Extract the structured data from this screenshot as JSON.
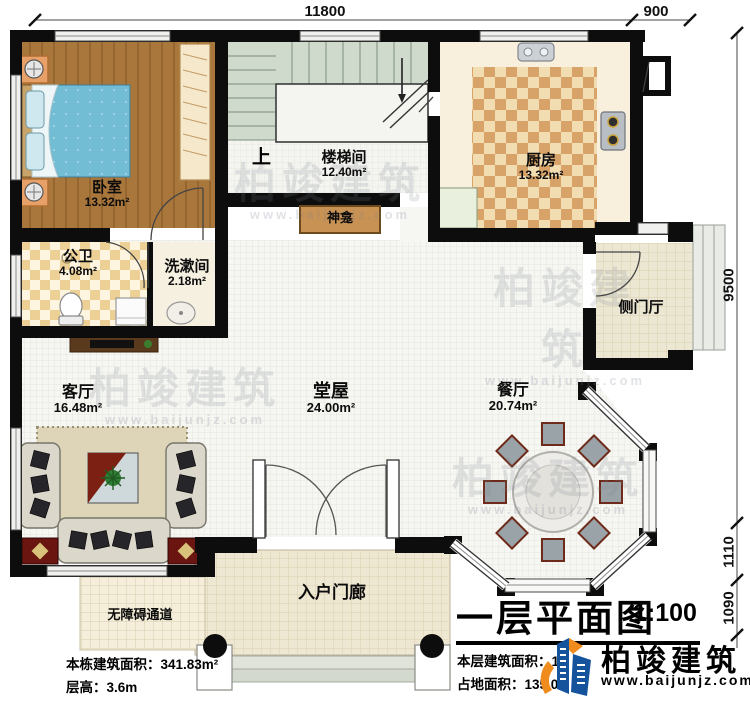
{
  "plan": {
    "title": "一层平面图",
    "scale": "1:100"
  },
  "dimensions": {
    "top_main": "11800",
    "top_right": "900",
    "right_main": "9500",
    "right_mid": "1110",
    "right_bottom": "1090"
  },
  "rooms": {
    "bedroom": {
      "name": "卧室",
      "area": "13.32m²"
    },
    "stairwell": {
      "name": "楼梯间",
      "area": "12.40m²"
    },
    "kitchen": {
      "name": "厨房",
      "area": "13.32m²"
    },
    "public_bath": {
      "name": "公卫",
      "area": "4.08m²"
    },
    "washroom": {
      "name": "洗漱间",
      "area": "2.18m²"
    },
    "living_room": {
      "name": "客厅",
      "area": "16.48m²"
    },
    "main_hall": {
      "name": "堂屋",
      "area": "24.00m²"
    },
    "dining_room": {
      "name": "餐厅",
      "area": "20.74m²"
    },
    "side_foyer": {
      "name": "侧门厅"
    },
    "entry_porch": {
      "name": "入户门廊"
    },
    "accessible_ramp": {
      "name": "无障碍通道"
    },
    "shrine": {
      "name": "神龛"
    },
    "stair_direction": "上"
  },
  "notes": {
    "total_area": "本栋建筑面积：341.83m²",
    "floor_height": "层高：3.6m",
    "floor_area": "本层建筑面积：12",
    "footprint": "占地面积：135.0"
  },
  "branding": {
    "company": "柏竣建筑",
    "website": "www.baijunjz.com"
  },
  "watermark": {
    "text": "柏竣建筑",
    "subtext": "www.baijunjz.com"
  }
}
